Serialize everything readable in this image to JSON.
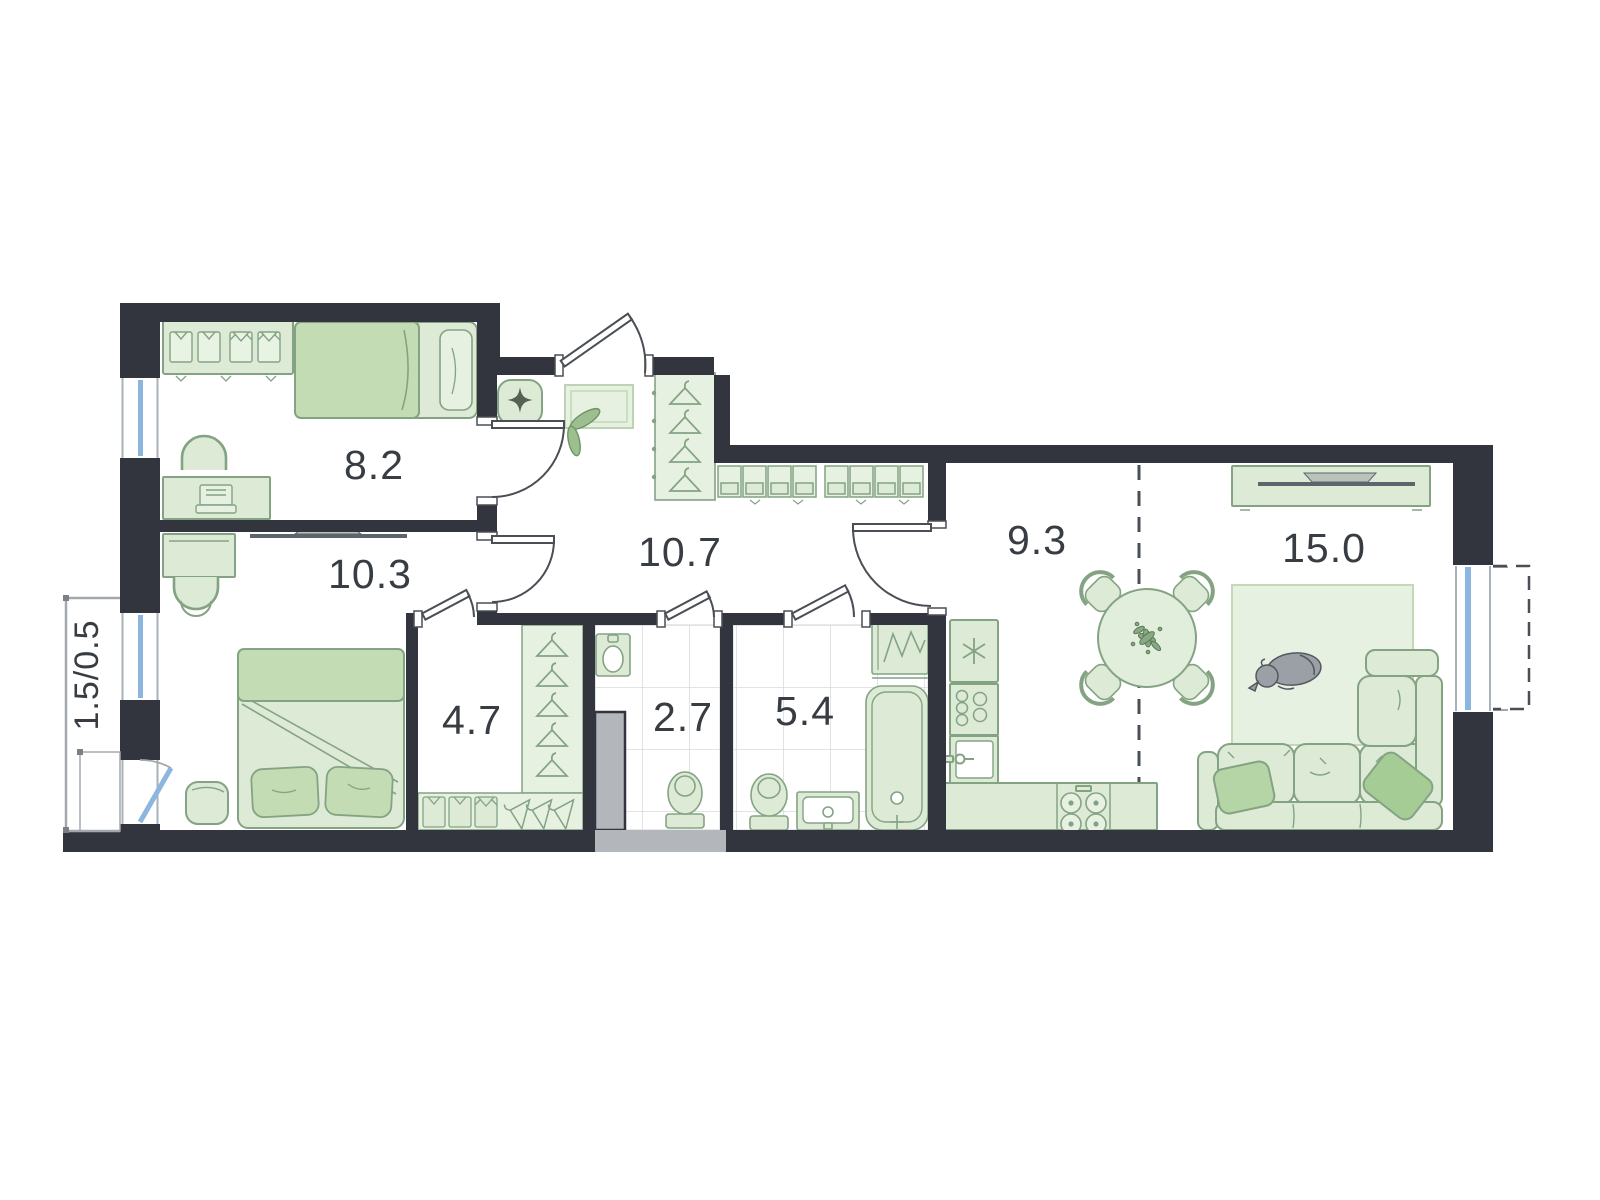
{
  "plan": {
    "rooms": {
      "bedroom_small": "8.2",
      "bedroom_master": "10.3",
      "hallway": "10.7",
      "wardrobe_room": "4.7",
      "wc": "2.7",
      "bathroom": "5.4",
      "kitchen": "9.3",
      "living_room": "15.0",
      "balcony": "1.5/0.5"
    },
    "colors": {
      "wall": "#32353d",
      "furniture_fill": "#dcead6",
      "furniture_fill_light": "#e7f1e1",
      "furniture_fill_dark": "#c3dcb4",
      "furniture_stroke": "#84a383",
      "window_glass": "#8cb6e0",
      "shaft": "#b3b6bb",
      "tile_line": "#cfd4d8",
      "door_line": "#4a4e55",
      "outline_gray": "#a3a8ae",
      "label_text": "#383c43",
      "dog": "#9aa0a5"
    }
  }
}
